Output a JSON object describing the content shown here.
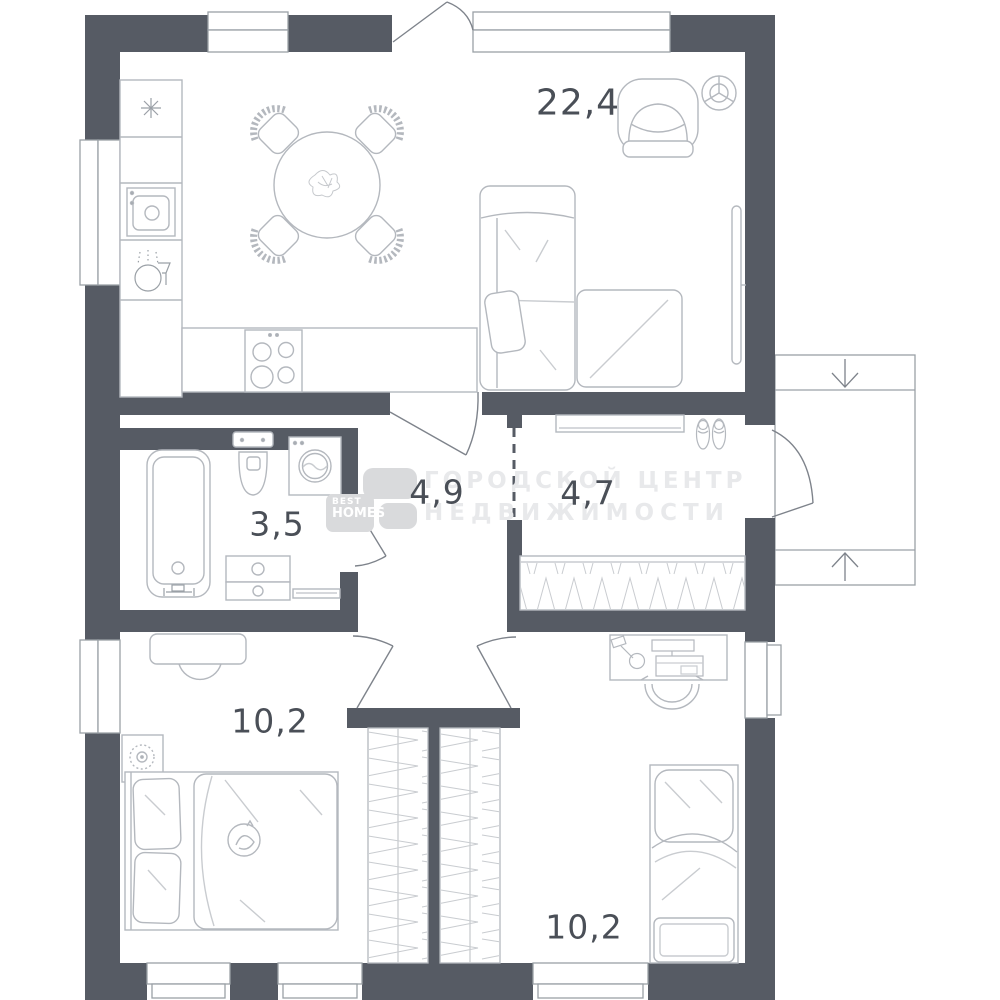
{
  "watermark": {
    "line1": "ГОРОДСКОЙ ЦЕНТР",
    "line2": "НЕДВИЖИМОСТИ"
  },
  "logo": {
    "top": "BEST",
    "bottom": "HOMES"
  },
  "rooms": [
    {
      "name": "kitchen-living-room",
      "area_label": "22,4",
      "furniture": [
        "fridge",
        "kitchen-counter",
        "kitchen-sink",
        "dishwasher",
        "stove",
        "dining-table",
        "dining-chairs",
        "sofa",
        "ottoman",
        "armchair",
        "tv",
        "ceiling-light"
      ]
    },
    {
      "name": "bathroom",
      "area_label": "3,5",
      "furniture": [
        "bathtub",
        "toilet",
        "washing-machine",
        "vanity-cabinet",
        "bath-mat"
      ]
    },
    {
      "name": "hallway",
      "area_label": "4,9",
      "furniture": []
    },
    {
      "name": "corridor",
      "area_label": "4,7",
      "furniture": [
        "shelf",
        "shoes",
        "wardrobe"
      ]
    },
    {
      "name": "bedroom-left",
      "area_label": "10,2",
      "furniture": [
        "dresser",
        "stool",
        "plant",
        "double-bed",
        "cat",
        "built-in-wardrobe"
      ]
    },
    {
      "name": "bedroom-right",
      "area_label": "10,2",
      "furniture": [
        "desk",
        "desk-lamp",
        "computer",
        "office-chair",
        "single-bed",
        "built-in-wardrobe"
      ]
    }
  ],
  "entrance": {
    "porch_arrows": [
      "down",
      "up"
    ]
  },
  "colors": {
    "wall": "#565b64",
    "furniture_line": "#b4b8be",
    "detail_line": "#c9ccd0",
    "window_line": "#9aa0a6",
    "door_line": "#7e838b",
    "label_text": "#4a4f57",
    "watermark": "#e8e9eb",
    "logo_tile": "#d9dadc",
    "background": "#ffffff"
  }
}
